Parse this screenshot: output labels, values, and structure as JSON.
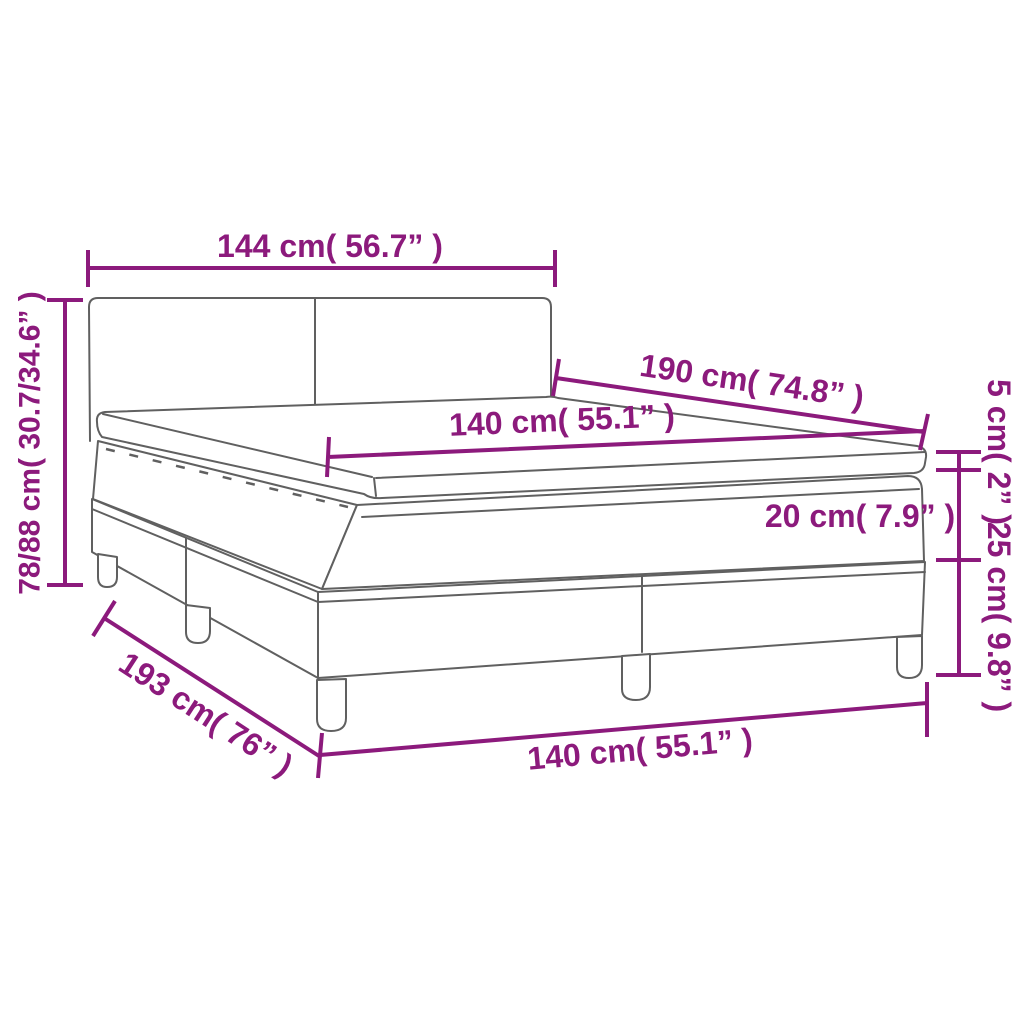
{
  "diagram": {
    "description": "Box spring bed with mattress and topper - dimension drawing",
    "labels": {
      "headboard_width": "144 cm( 56.7” )",
      "bed_length": "190 cm( 74.8” )",
      "mattress_width_top": "140 cm( 55.1” )",
      "total_height": "78/88 cm( 30.7/34.6” )",
      "topper_height": "5 cm( 2” )",
      "mattress_height": "20 cm( 7.9” )",
      "base_height": "25 cm( 9.8” )",
      "total_length": "193 cm( 76” )",
      "mattress_width_bottom": "140 cm( 55.1” )"
    },
    "colors": {
      "dimension_accent": "#8C1A7C",
      "drawing_line": "#606060",
      "background": "#FFFFFF"
    }
  }
}
